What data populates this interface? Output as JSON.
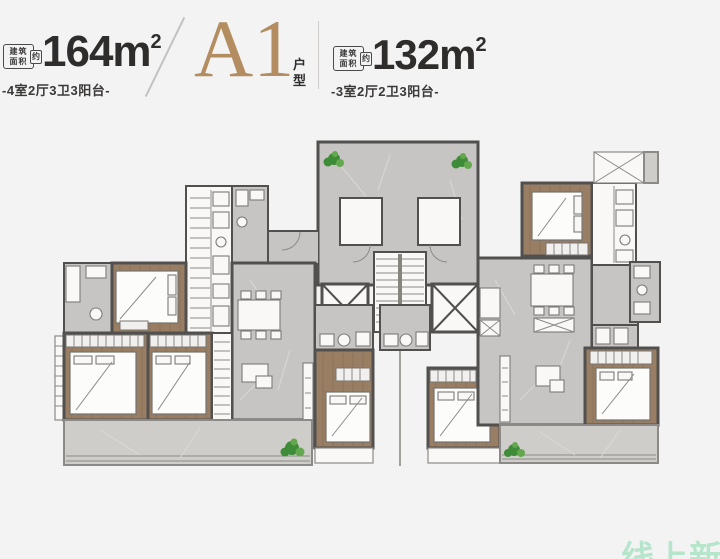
{
  "header": {
    "units": [
      {
        "badge": {
          "top": "建筑",
          "bottom": "面积",
          "tag": "约"
        },
        "area": "164",
        "unit": "m",
        "sup": "2",
        "spec": "-4室2厅3卫3阳台-"
      },
      {
        "badge": {
          "top": "建筑",
          "bottom": "面积",
          "tag": "约"
        },
        "area": "132",
        "unit": "m",
        "sup": "2",
        "spec": "-3室2厅2卫3阳台-"
      }
    ],
    "plan_code": "A1",
    "plan_type_chars": [
      "户",
      "型"
    ]
  },
  "watermark": {
    "text": "线上新房"
  },
  "colors": {
    "bg": "#f3f3f4",
    "ink": "#2e2d2c",
    "bronze": "#b38d5f",
    "wall": "#51504e",
    "gray": "#c7c5c3",
    "gray2": "#cfcdca",
    "white": "#f9f8f7",
    "wood": "#997e64",
    "woodline": "#6f5a44",
    "green": "#3f8c38",
    "green2": "#63a84e",
    "mint": "#abe3c4"
  }
}
